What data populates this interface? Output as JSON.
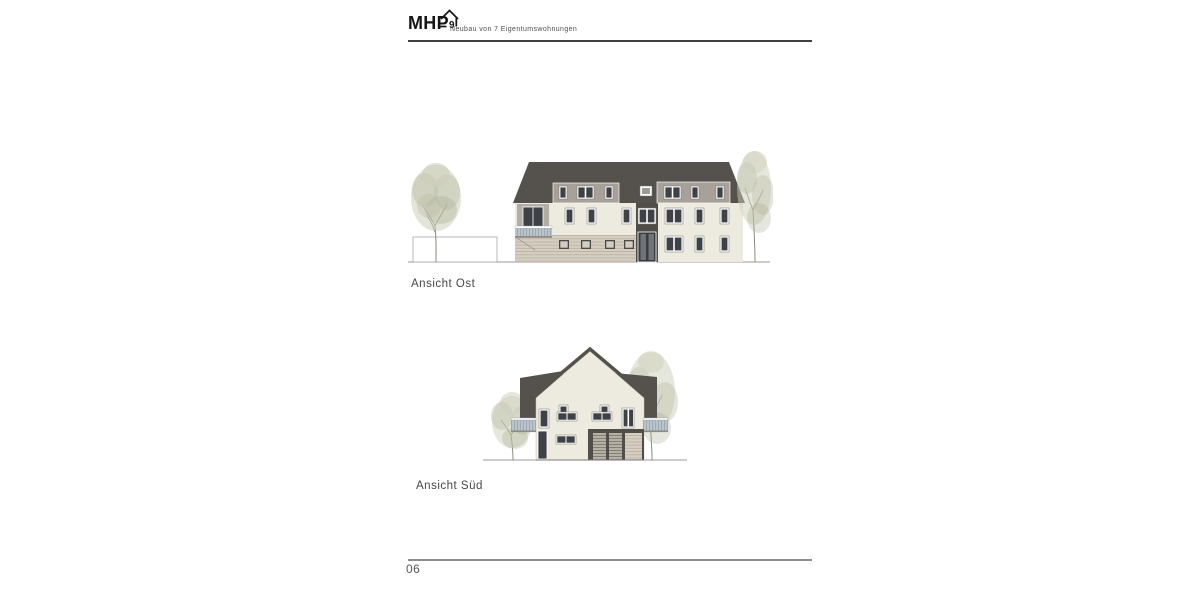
{
  "header": {
    "logo_text": "MHP",
    "logo_mark": "9",
    "tagline": "Neubau von 7 Eigentumswohnungen"
  },
  "drawings": {
    "east": {
      "label": "Ansicht Ost"
    },
    "south": {
      "label": "Ansicht Süd"
    }
  },
  "footer": {
    "page_number": "06"
  },
  "colors": {
    "roof": "#55524d",
    "dormer": "#a7a199",
    "wall": "#edeadf",
    "siding": "#d5cec1",
    "siding_line": "#b9b0a0",
    "dark_strip": "#514e49",
    "glass": "#3e4145",
    "frame": "#ffffff",
    "railing": "#bac5cb",
    "railing_bar": "#97a6af",
    "qframe": "#4c4a45",
    "qglass": "#d0cdc4",
    "door_glass": "#70747a",
    "foliage_light": "#cdcfba",
    "foliage_mid": "#bcbfa6",
    "foliage_dark": "#a9ad90",
    "trunk": "#8f8a7a",
    "ground_line": "#9a9a9a",
    "text": "#474747",
    "logo": "#161616",
    "rule_dark": "#3f3f3f",
    "rule_light": "#8d8d8d",
    "slat": "#b6b0a6",
    "slat_line": "#77736b"
  }
}
